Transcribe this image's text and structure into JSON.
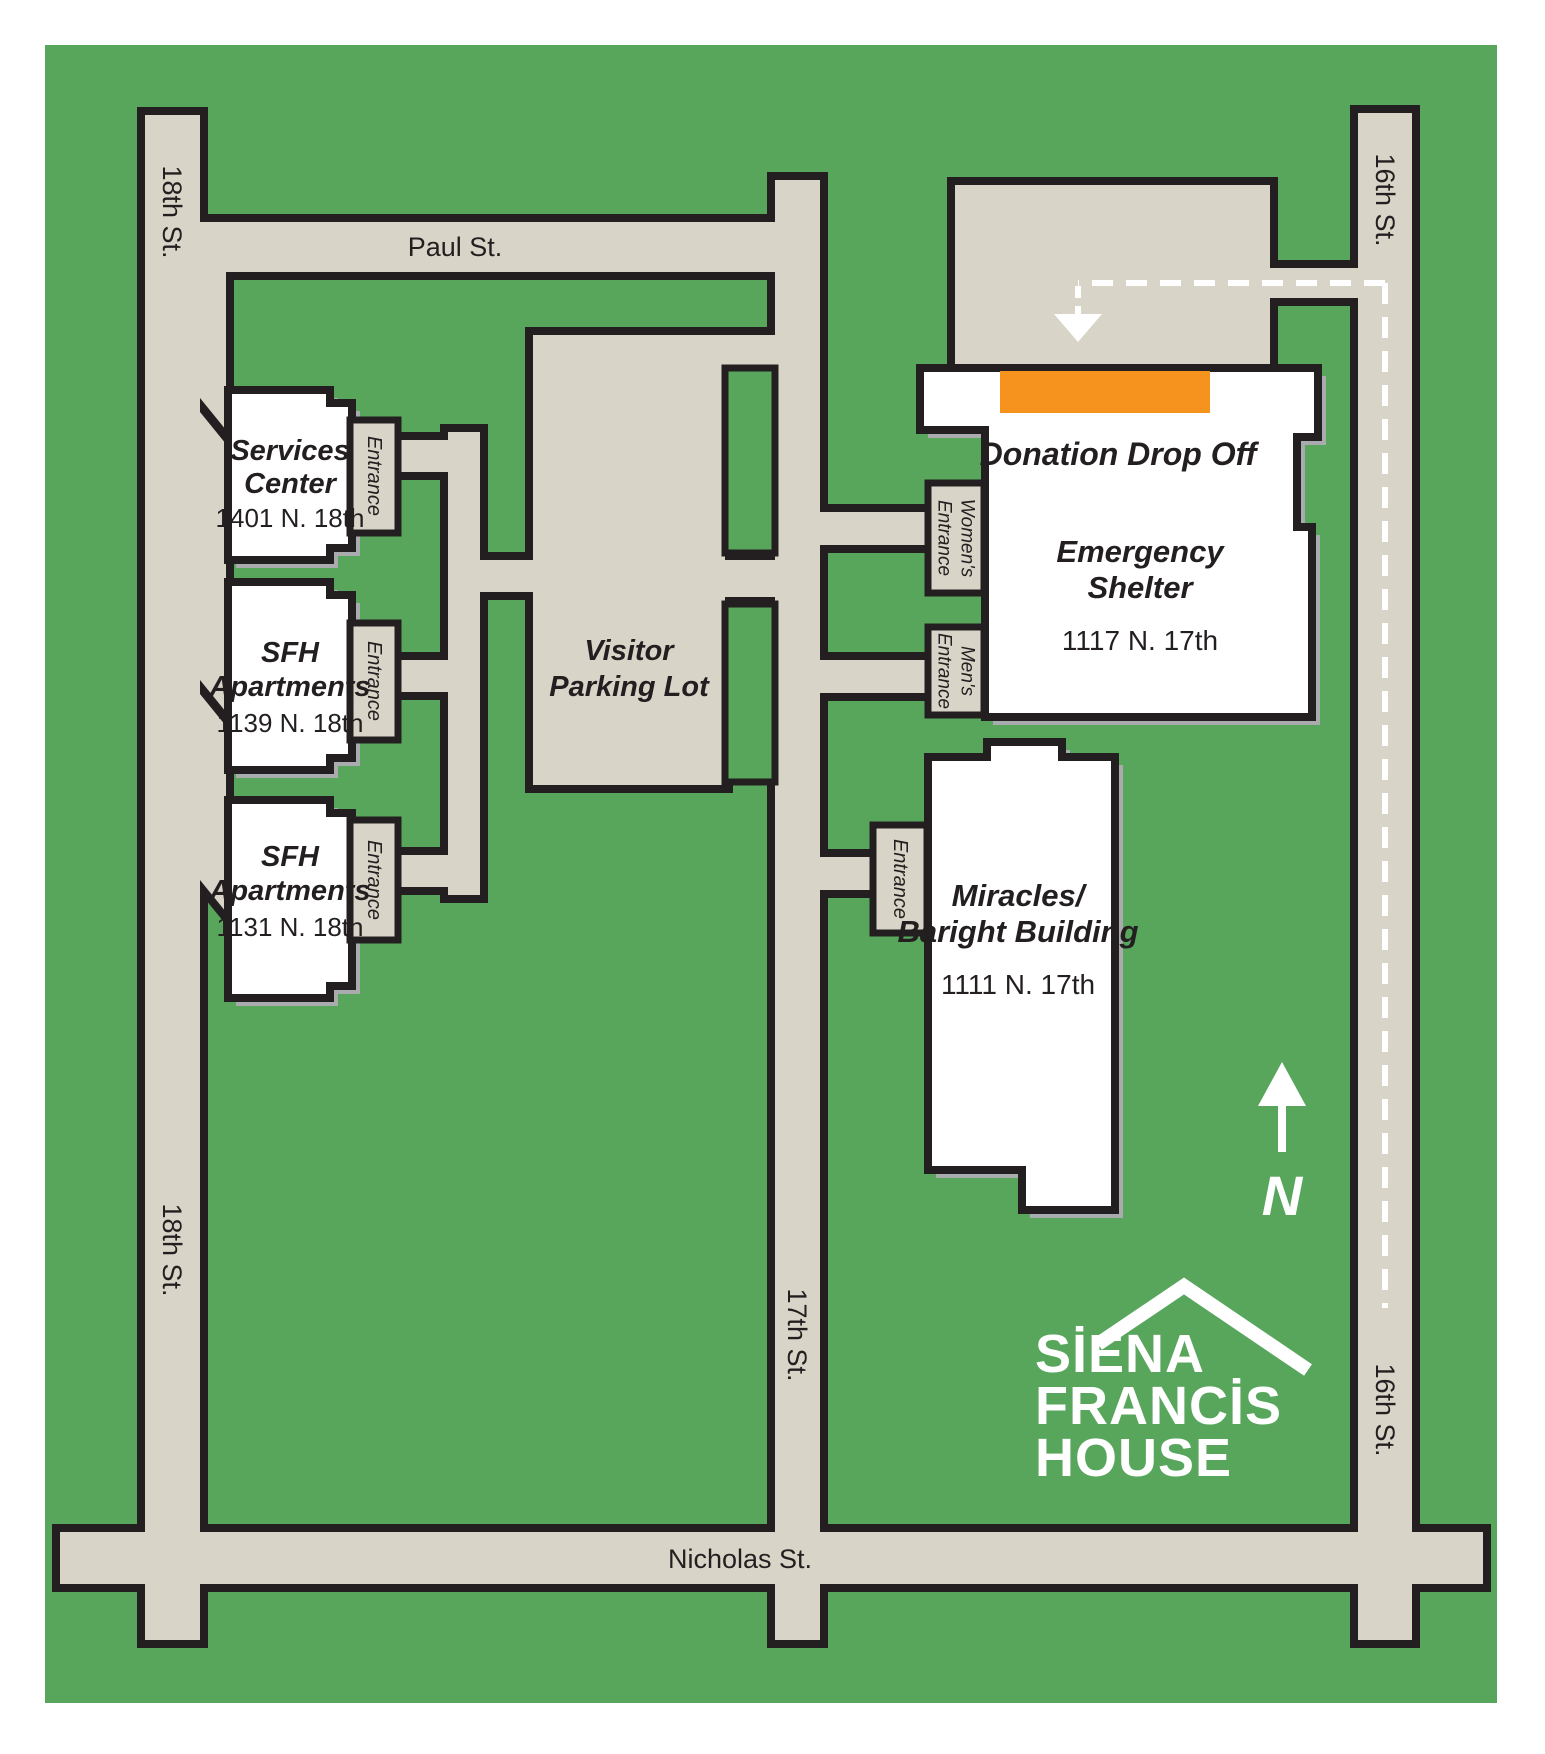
{
  "map": {
    "streets": {
      "paul": "Paul St.",
      "nicholas": "Nicholas St.",
      "eighteenth": "18th St.",
      "seventeenth": "17th St.",
      "sixteenth": "16th St."
    },
    "buildings": {
      "services_center": {
        "title": [
          "Services",
          "Center"
        ],
        "address": "1401 N. 18th",
        "entrance": "Entrance"
      },
      "sfh_1139": {
        "title": [
          "SFH",
          "Apartments"
        ],
        "address": "1139 N. 18th",
        "entrance": "Entrance"
      },
      "sfh_1131": {
        "title": [
          "SFH",
          "Apartments"
        ],
        "address": "1131 N. 18th",
        "entrance": "Entrance"
      },
      "visitor_parking": {
        "title": [
          "Visitor",
          "Parking Lot"
        ]
      },
      "emergency_shelter": {
        "donation": "Donation Drop Off",
        "title": [
          "Emergency",
          "Shelter"
        ],
        "address": "1117 N. 17th",
        "womens_entrance": [
          "Women's",
          "Entrance"
        ],
        "mens_entrance": [
          "Men's",
          "Entrance"
        ]
      },
      "miracles": {
        "title": [
          "Miracles/",
          "Baright Building"
        ],
        "address": "1111 N. 17th",
        "entrance": "Entrance"
      }
    },
    "compass": "N",
    "logo": [
      "SİENA",
      "FRANCİS",
      "HOUSE"
    ],
    "colors": {
      "green": "#58A65C",
      "road": "#D8D4C7",
      "outline": "#231F20",
      "orange": "#F6921E",
      "building": "#FFFFFF",
      "shadow": "#A9ABAE",
      "dash": "#FFFFFF"
    }
  }
}
